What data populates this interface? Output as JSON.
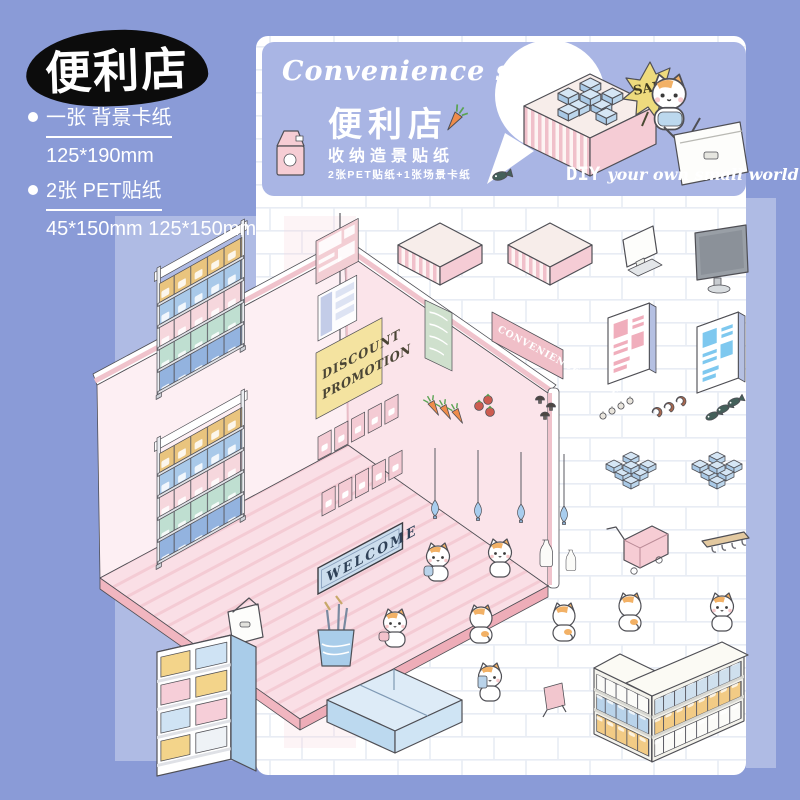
{
  "colors": {
    "background": "#8a9bd7",
    "banner_blue": "#a9b5e4",
    "page_white": "#ffffff",
    "tile_line": "#e8ecf4",
    "room_wall_pink": "#fbe4ea",
    "floor_pink": "#fadfe6",
    "accent_pink": "#f2c3cc",
    "sticker_blue": "#b9d6ee",
    "sign_yellow": "#f4e3a0",
    "sale_yellow": "#eedb7d",
    "cat_orange": "#f2b166",
    "outline": "#4f4f55"
  },
  "header": {
    "store_title": "便利店"
  },
  "specs": {
    "items": [
      {
        "label": "一张  背景卡纸",
        "size": "125*190mm"
      },
      {
        "label": "2张  PET贴纸",
        "size": "45*150mm 125*150mm"
      }
    ]
  },
  "banner": {
    "title_en": "Convenience store",
    "title_zh": "便利店",
    "subtitle": "收纳造景贴纸",
    "note": "2张PET贴纸+1张场景卡纸",
    "sale_label": "SALE",
    "diy_prefix": "DIY",
    "diy_suffix": "your own small world"
  },
  "room": {
    "welcome_mat": "WELCOME",
    "discount_sign_line1": "DISCOUNT",
    "discount_sign_line2": "PROMOTION",
    "store_banner": "CONVENIENCE STORE"
  },
  "stickers": {
    "icon_names": [
      "shelf-unit",
      "display-platform",
      "pos-monitor",
      "tv-monitor",
      "menu-board-sign",
      "store-banner-sign",
      "wall-cabinet-pink",
      "wall-cabinet-blue",
      "carrot",
      "tomato",
      "mushroom",
      "garlic",
      "shrimp",
      "fish",
      "pendant-lamp",
      "ice-box-pile",
      "milk-bottle",
      "shopping-cart",
      "coat-hook-rack",
      "cat",
      "shopping-basket",
      "umbrella-bucket",
      "display-crate",
      "drink-cabinet",
      "checkout-counter",
      "welcome-mat",
      "discount-sign",
      "easel-sign",
      "milk-carton",
      "sale-starburst"
    ]
  }
}
